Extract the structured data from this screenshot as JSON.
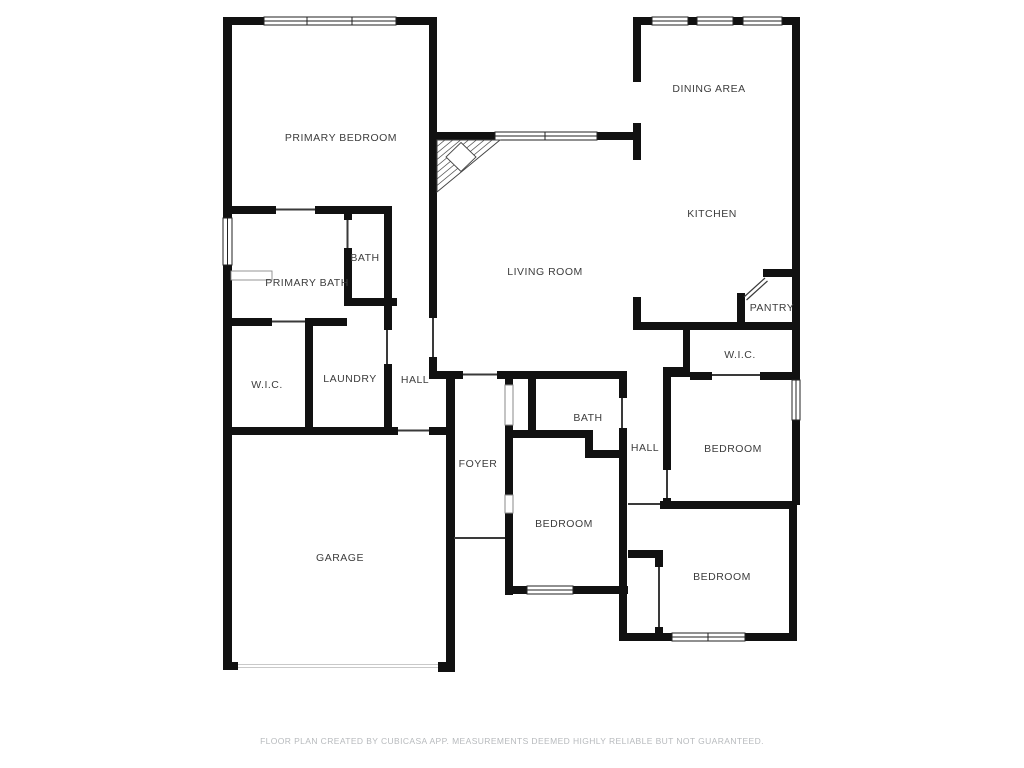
{
  "floor_plan": {
    "title": "Residential floor plan",
    "rooms": {
      "primary_bedroom": "PRIMARY BEDROOM",
      "dining_area": "DINING AREA",
      "kitchen": "KITCHEN",
      "living_room": "LIVING ROOM",
      "bath_upper": "BATH",
      "primary_bath": "PRIMARY BATH",
      "pantry": "PANTRY",
      "wic_left": "W.I.C.",
      "laundry": "LAUNDRY",
      "hall_left": "HALL",
      "wic_right": "W.I.C.",
      "hall_right": "HALL",
      "bedroom_right": "BEDROOM",
      "bath_center": "BATH",
      "foyer": "FOYER",
      "bedroom_center": "BEDROOM",
      "garage": "GARAGE",
      "bedroom_bottom": "BEDROOM"
    },
    "footer": {
      "disclaimer": "FLOOR PLAN CREATED BY CUBICASA APP. MEASUREMENTS DEEMED HIGHLY RELIABLE BUT NOT GUARANTEED."
    },
    "colors": {
      "wall": "#111111",
      "label": "#3d3d3d",
      "footer_text": "#b7babd",
      "background": "#ffffff"
    }
  }
}
